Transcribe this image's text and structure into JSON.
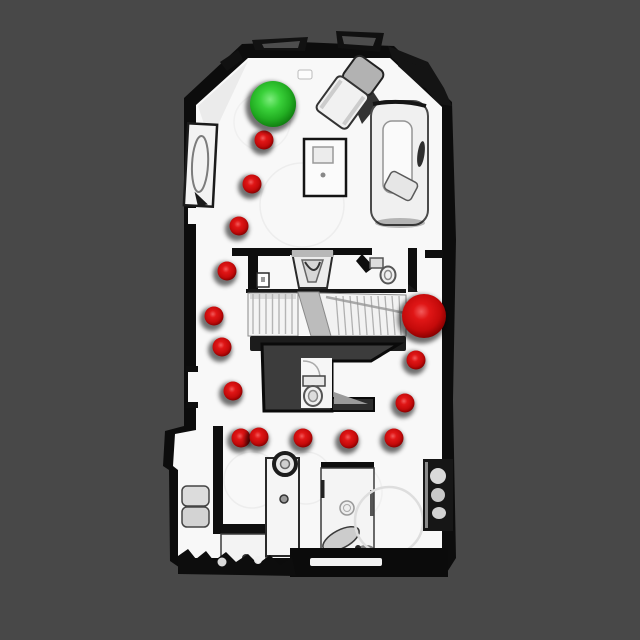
{
  "viewer": {
    "canvas_width": 640,
    "canvas_height": 640,
    "background_color": "#484848"
  },
  "floor_plan": {
    "floor_color": "#f8f8f8",
    "wall_color": "#0c0c0c",
    "stairwell_color": "#3c3c3c"
  },
  "markers": {
    "green_sphere": {
      "x": 273,
      "y": 104,
      "r": 23,
      "color": "#2ec82e",
      "gradient": [
        [
          "0%",
          "#7dec7d"
        ],
        [
          "35%",
          "#3ad13a"
        ],
        [
          "70%",
          "#22ae22"
        ],
        [
          "100%",
          "#0f7c0f"
        ]
      ]
    },
    "red_sphere_large": {
      "x": 424,
      "y": 316,
      "r": 22,
      "color": "#dd1111",
      "gradient": [
        [
          "0%",
          "#f25b5b"
        ],
        [
          "30%",
          "#e01616"
        ],
        [
          "70%",
          "#c40a0a"
        ],
        [
          "100%",
          "#850000"
        ]
      ]
    },
    "red_waypoints": {
      "r": 9.5,
      "color": "#dd1111",
      "points": [
        {
          "x": 264,
          "y": 140
        },
        {
          "x": 252,
          "y": 184
        },
        {
          "x": 239,
          "y": 226
        },
        {
          "x": 227,
          "y": 271
        },
        {
          "x": 214,
          "y": 316
        },
        {
          "x": 222,
          "y": 347
        },
        {
          "x": 233,
          "y": 391
        },
        {
          "x": 241,
          "y": 438
        },
        {
          "x": 259,
          "y": 437
        },
        {
          "x": 303,
          "y": 438
        },
        {
          "x": 349,
          "y": 439
        },
        {
          "x": 394,
          "y": 438
        },
        {
          "x": 416,
          "y": 360
        },
        {
          "x": 405,
          "y": 403
        }
      ]
    }
  }
}
